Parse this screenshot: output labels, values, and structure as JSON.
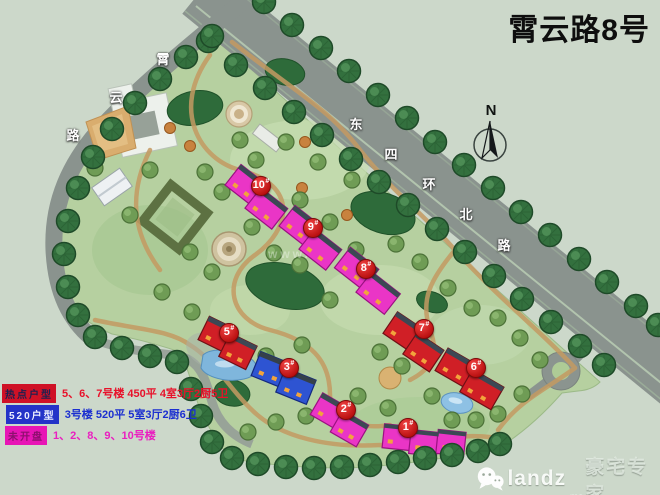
{
  "title": "霄云路8号",
  "roads": {
    "xiaoyun": {
      "name": "霄云路",
      "chars": [
        "霄",
        "云",
        "路"
      ]
    },
    "dongsihuan": {
      "name": "东四环北路",
      "chars": [
        "东",
        "四",
        "环",
        "北",
        "路"
      ]
    }
  },
  "compass": {
    "north": "N"
  },
  "buildings": [
    {
      "num": "10",
      "mark": "#",
      "color": "#ea35c6"
    },
    {
      "num": "9",
      "mark": "#",
      "color": "#ea35c6"
    },
    {
      "num": "8",
      "mark": "#",
      "color": "#ea35c6"
    },
    {
      "num": "5",
      "mark": "#",
      "color": "#d01f26"
    },
    {
      "num": "3",
      "mark": "#",
      "color": "#2e54d2"
    },
    {
      "num": "2",
      "mark": "#",
      "color": "#ea35c6"
    },
    {
      "num": "7",
      "mark": "#",
      "color": "#d01f26"
    },
    {
      "num": "6",
      "mark": "#",
      "color": "#d01f26"
    },
    {
      "num": "1",
      "mark": "#",
      "color": "#ea35c6"
    }
  ],
  "legend": {
    "rows": [
      {
        "tag": "热点户型",
        "desc": "5、6、7号楼 450平 4室3厅2厨5卫",
        "color": "#e8112a",
        "tag_bg": "#cf1126"
      },
      {
        "tag": "520户型",
        "desc": "3号楼 520平 5室3厅2厨6卫",
        "color": "#1b2fd0",
        "tag_bg": "#2433c8"
      },
      {
        "tag": "未开盘",
        "desc": "1、2、8、9、10号楼",
        "color": "#ea1fc0",
        "tag_bg": "#e715b5"
      }
    ]
  },
  "watermark_center": "www.",
  "watermark": {
    "brand": "landz",
    "suffix": ".ms",
    "name": "豪宅专家"
  }
}
